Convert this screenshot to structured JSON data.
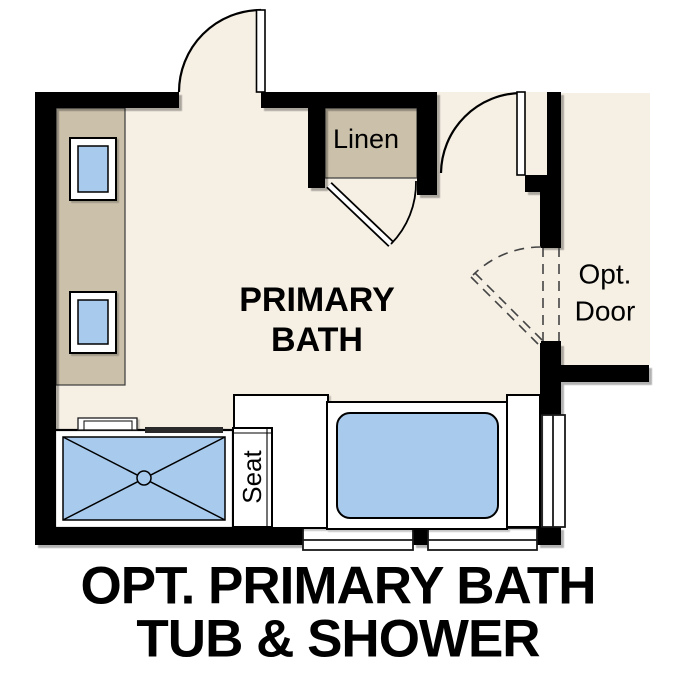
{
  "plan": {
    "room_label": {
      "line1": "PRIMARY",
      "line2": "BATH"
    },
    "closet_label": "Linen",
    "optional_door_label": {
      "line1": "Opt.",
      "line2": "Door"
    },
    "seat_label": "Seat"
  },
  "caption": {
    "line1": "OPT. PRIMARY BATH",
    "line2": "TUB & SHOWER"
  },
  "colors": {
    "wall": "#000000",
    "floor": "#f5efe4",
    "cabinet": "#cbc1ab",
    "fixture_blue": "#a8caec",
    "fixture_white": "#ffffff",
    "text": "#000000"
  }
}
